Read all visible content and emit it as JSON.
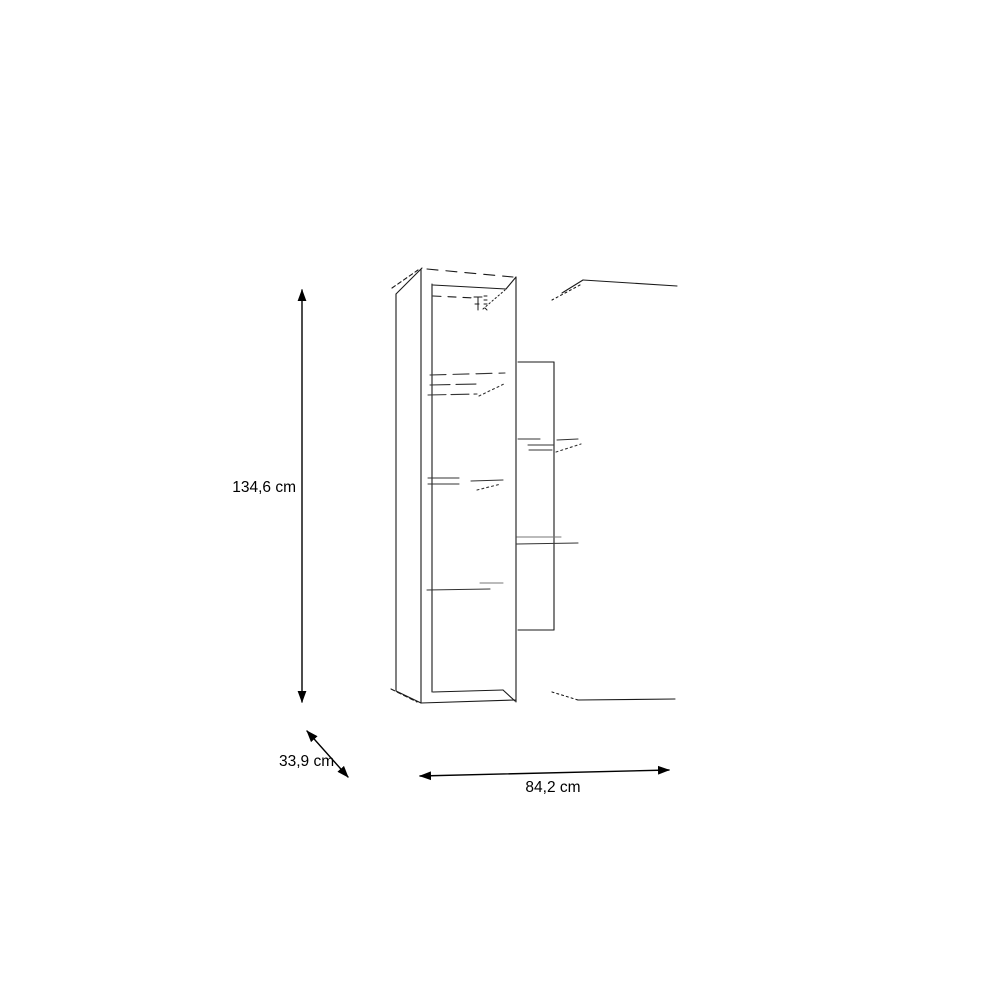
{
  "page": {
    "background_color": "#ffffff"
  },
  "diagram": {
    "kind": "furniture-dimension-line-drawing",
    "subject": "tall wall-mounted cabinet with interior shelves and adjacent wall shelf unit",
    "line_color": "#1a1a1a",
    "sketch_line_color": "#333333",
    "faint_line_color": "#777777",
    "text_color": "#000000",
    "dimensions": {
      "height_label": "134,6 cm",
      "depth_label": "33,9 cm",
      "width_label": "84,2 cm"
    }
  }
}
